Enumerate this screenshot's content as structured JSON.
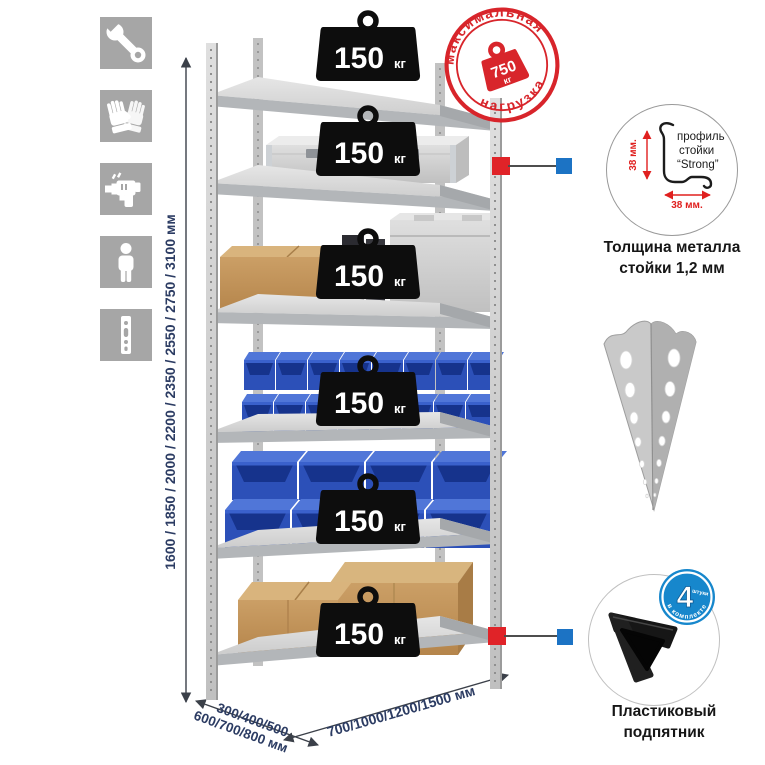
{
  "meta": {
    "title": "Металлический стеллаж — инфографика"
  },
  "left_icons": [
    {
      "name": "wrench-icon"
    },
    {
      "name": "gloves-icon"
    },
    {
      "name": "drill-icon"
    },
    {
      "name": "person-icon"
    },
    {
      "name": "rack-post-icon"
    }
  ],
  "height_dimension": {
    "label": "1600 / 1850 / 2000 / 2200 / 2350 / 2550 / 2750 / 3100 мм"
  },
  "stamp": {
    "arc_top": "максимальная",
    "arc_bottom": "нагрузка",
    "weight_value": "750",
    "weight_unit": "кг",
    "color": "#d8252b"
  },
  "rack": {
    "badge_value": "150",
    "badge_unit": "кг",
    "shelf_badges": [
      "150 кг",
      "150 кг",
      "150 кг",
      "150 кг",
      "150 кг",
      "150 кг"
    ],
    "items": [
      "aluminum-case",
      "cardboard-box-canisters-case",
      "small-blue-bins",
      "large-blue-bins",
      "cardboard-boxes"
    ]
  },
  "profile_detail": {
    "dim_vertical": "38 мм.",
    "dim_horizontal": "38 мм.",
    "label_line1": "профиль",
    "label_line2": "стойки",
    "label_line3": "“Strong”",
    "caption_line1": "Толщина металла",
    "caption_line2": "стойки 1,2 мм"
  },
  "foot_detail": {
    "badge_number": "4",
    "badge_small_text": "штуки",
    "badge_arc_text": "в комплекте",
    "caption_line1": "Пластиковый",
    "caption_line2": "подпятник"
  },
  "depth_dimension": {
    "line1": "300/400/500",
    "line2": "600/700/800 мм"
  },
  "width_dimension": {
    "label": "700/1000/1200/1500 мм"
  },
  "colors": {
    "accent_red": "#e02328",
    "accent_blue": "#1c73c4",
    "navy_text": "#2c3c63",
    "icon_gray": "#a6a6a6",
    "bin_blue": "#2c50b8",
    "metal_gray": "#c9c9c9",
    "cardboard": "#c49659"
  }
}
